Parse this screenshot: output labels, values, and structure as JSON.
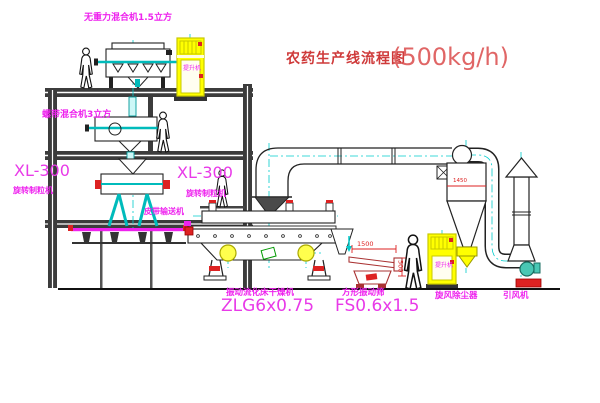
{
  "title": {
    "text": "农药生产线流程图",
    "capacity": "(500kg/h)"
  },
  "labels": {
    "mixer_top": "无重力混合机1.5立方",
    "mixer_mid": "螺带混合机3立方",
    "granulator1_model": "XL-300",
    "granulator1_name": "旋转制粒机",
    "granulator2_model": "XL-300",
    "granulator2_name": "旋转制粒机",
    "belt_conveyor": "皮带输送机",
    "dryer_name": "振动流化床干燥机",
    "dryer_model": "ZLG6x0.75",
    "screen_name": "方形振动筛",
    "screen_model": "FS0.6x1.5",
    "cyclone": "旋风除尘器",
    "fan": "引风机",
    "elevator1": "提升机",
    "elevator2": "提升机"
  },
  "dimensions": {
    "screen_length": "1500",
    "screen_height": "500",
    "cyclone_note": "1450"
  },
  "colors": {
    "label_magenta": "#ee22ee",
    "title_red": "#cf3a3a",
    "dimension_red": "#dd2222",
    "elevator_yellow": "#ffff00",
    "centerline_cyan": "#00cccc",
    "structure_gray": "#3c3c3c",
    "screen_maroon": "#aa3333",
    "fan_green": "#49c7b4"
  }
}
